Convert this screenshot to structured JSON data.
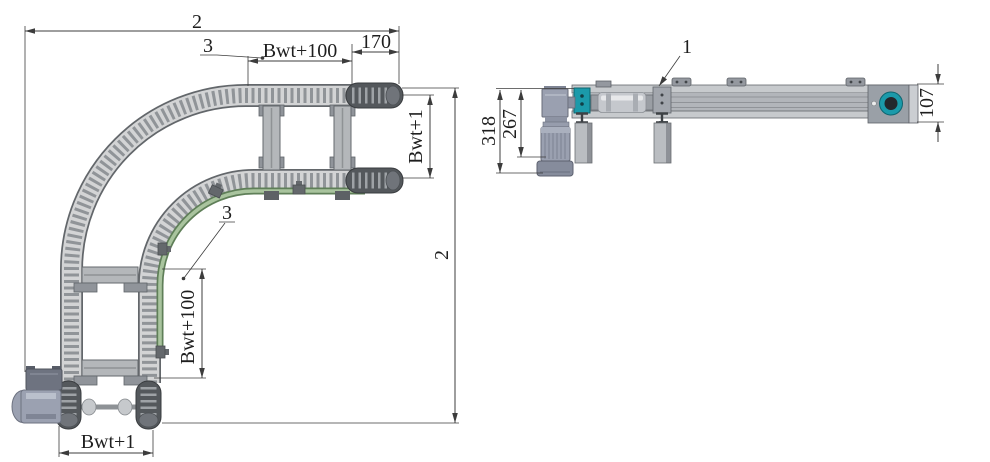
{
  "top_view": {
    "dim_overall_width": "2",
    "dim_overall_height": "2",
    "dim_end_offset": "170",
    "dim_track_width_top": "Bwt+100",
    "dim_track_width_side": "Bwt+100",
    "dim_chain_width_right": "Bwt+1",
    "dim_chain_width_bottom": "Bwt+1",
    "callout_guide_rail_top": "3",
    "callout_guide_rail_side": "3"
  },
  "side_view": {
    "callout_beam": "1",
    "dim_height_overall": "318",
    "dim_height_motor": "267",
    "dim_beam_height": "107"
  },
  "colors": {
    "accent_teal": "#1b9aaa",
    "guide_rail_green": "#a9c49e",
    "guide_rail_green_dark": "#5f7f58",
    "dimension_line": "#3c3c3c",
    "metal_light": "#d3d4d5",
    "metal_mid": "#b2b5ba",
    "metal_dark": "#54585c",
    "motor_gray": "#9aa0b0",
    "background": "#ffffff"
  }
}
